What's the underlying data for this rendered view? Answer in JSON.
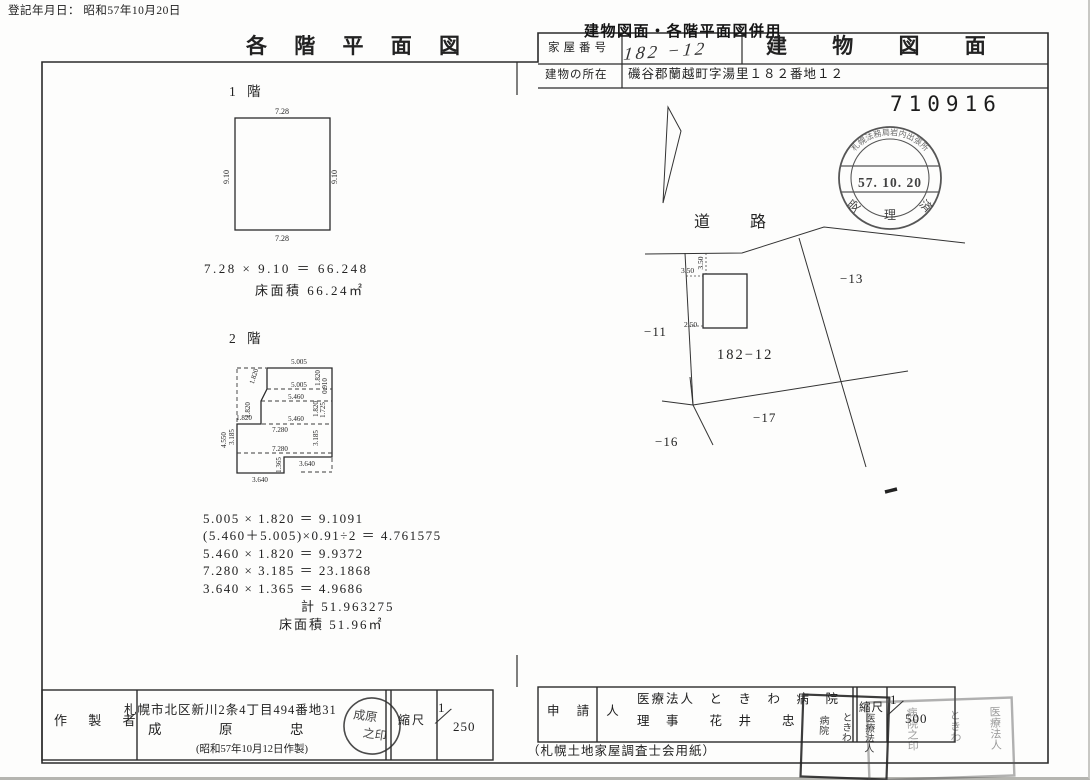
{
  "page": {
    "registration_date": "登記年月日： 昭和57年10月20日",
    "serial_number": "710916",
    "paper_note": "（札幌土地家屋調査士会用紙）"
  },
  "header": {
    "overlay_stamp": "建物図面・各階平面図併用",
    "floor_plan_title": "各 階 平 面 図",
    "building_drawing_title": "建 物 図 面",
    "house_number_label": "家屋番号",
    "house_number_value": "182 −12",
    "location_label": "建物の所在",
    "location_value": "磯谷郡蘭越町字湯里１８２番地１２"
  },
  "receipt_stamp": {
    "arc_text": "札幌法務局岩内出張所",
    "date": "57. 10. 20",
    "bottom_left": "受",
    "bottom_center": "理",
    "bottom_right": "済"
  },
  "floor1": {
    "label": "1 階",
    "dim_top": "7.28",
    "dim_bottom": "7.28",
    "dim_left": "9.10",
    "dim_right": "9.10",
    "calc": "7.28 × 9.10 ＝ 66.248",
    "area_line": "床面積 66.24㎡"
  },
  "floor2": {
    "label": "2 階",
    "dims": {
      "top": "5.005",
      "in1": "5.005",
      "in2": "5.460",
      "in3": "5.460",
      "in4": "7.280",
      "in5": "7.280",
      "bottom_right": "3.640",
      "bottom": "3.640",
      "left_out": "4.550",
      "left_in": "3.185",
      "left_step": "1.820",
      "left_v": "1.820",
      "left_slant": "1.820",
      "r1_in": "1.820",
      "r1_out": "0.910",
      "r2_in": "1.820",
      "r2_out": "1.725",
      "r3": "3.185",
      "step_v": "1.365"
    },
    "calc_lines": [
      "5.005 × 1.820 ＝  9.1091",
      "(5.460＋5.005)×0.91÷2 ＝ 4.761575",
      "5.460 × 1.820 ＝  9.9372",
      "7.280 × 3.185 ＝ 23.1868",
      "3.640 × 1.365 ＝  4.9686"
    ],
    "total_line": "計 51.963275",
    "area_line": "床面積 51.96㎡"
  },
  "site_plan": {
    "road_label": "道路",
    "main_lot": "182−12",
    "lot_11": "−11",
    "lot_13": "−13",
    "lot_16": "−16",
    "lot_17": "−17",
    "offset_top_rot": "3.50",
    "offset_left": "3.50",
    "offset_bottom": "2.50"
  },
  "maker": {
    "label": "作 製 者",
    "address": "札幌市北区新川2条4丁目494番地31",
    "name": "成　原　忠",
    "made_date": "(昭和57年10月12日作製)",
    "scale_label": "縮尺",
    "scale_num": "1",
    "scale_den": "250",
    "seal_c1": "成原",
    "seal_c2": "之印"
  },
  "applicant": {
    "label": "申 請 人",
    "line1": "医療法人　と　き　わ　病　院",
    "line2": "理　事　　花　井　　忠",
    "scale_label": "縮尺",
    "scale_num": "1",
    "scale_den": "500",
    "seal1_c1": "医療法人",
    "seal1_c2": "ときわ",
    "seal1_c3": "病院",
    "seal2_c1": "医療法人",
    "seal2_c2": "ときわ",
    "seal2_c3": "病院之印"
  }
}
